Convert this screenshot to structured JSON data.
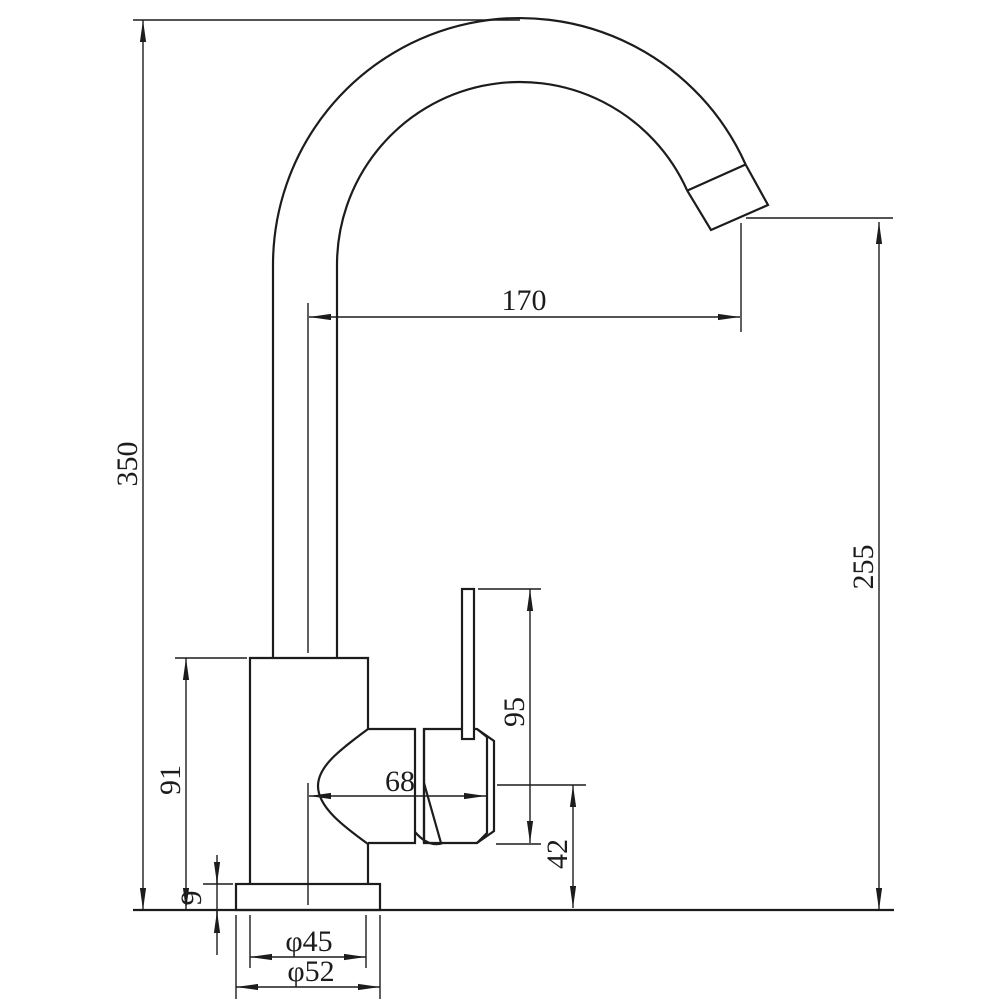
{
  "drawing": {
    "type": "technical-dimension-drawing",
    "subject": "kitchen-sink-mixer-faucet-side-elevation",
    "units": "mm",
    "colors": {
      "line": "#1c1c1c",
      "background": "#ffffff"
    },
    "dimensions": {
      "overall_height": "350",
      "spout_reach": "170",
      "outlet_height": "255",
      "body_height": "91",
      "deck_plate_thickness": "9",
      "handle_height": "95",
      "cartridge_length": "68",
      "cartridge_center_height": "42",
      "body_diameter": "φ45",
      "base_diameter": "φ52"
    }
  }
}
